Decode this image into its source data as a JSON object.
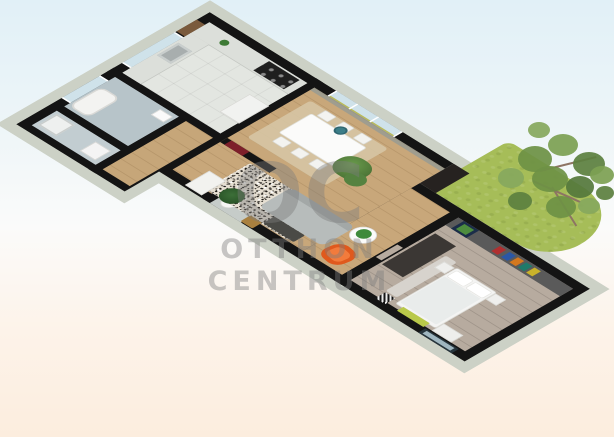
{
  "watermark": {
    "logo": "OC",
    "line1": "OTTHON",
    "line2": "CENTRUM"
  },
  "scene": {
    "kind": "3d-floor-plan-render-isometric",
    "rooms": [
      {
        "name": "kitchen"
      },
      {
        "name": "dining-room"
      },
      {
        "name": "living-room"
      },
      {
        "name": "bedroom"
      },
      {
        "name": "bathroom"
      },
      {
        "name": "shower-room"
      },
      {
        "name": "wc"
      },
      {
        "name": "hall"
      },
      {
        "name": "entry"
      },
      {
        "name": "garden"
      }
    ],
    "furniture": [
      "kitchen-counter",
      "stove",
      "sink",
      "fridge",
      "wall-cabinet",
      "dining-table",
      "dining-chairs",
      "pendant-lamp",
      "potted-plant",
      "dining-rug",
      "sofa",
      "coffee-table",
      "speckled-rug",
      "orange-armchair",
      "round-side-table",
      "floor-plant",
      "wooden-chair",
      "white-chest",
      "toilet",
      "bathtub",
      "wash-basin",
      "shower",
      "washing-machine",
      "bed",
      "pillows",
      "duvet",
      "dresser",
      "nightstands",
      "runner-rug",
      "bench",
      "striped-pouf",
      "wall-art",
      "bedroom-doors",
      "front-door",
      "interior-red-doors",
      "windows",
      "lawn",
      "tree"
    ]
  },
  "colors": {
    "bg_top": "#e1f0f7",
    "bg_mid": "#fbfbfa",
    "bg_bottom": "#fcedde",
    "wall": "#141414",
    "slab": "#ccd1c6",
    "wood": "#c8a77a",
    "bedroom_floor": "#b7ab9f",
    "kitchen_floor": "#e3e6e1",
    "lawn": "#a6bd58",
    "accent_wall": "#5a5a5a",
    "sofa": "#b7bcbb",
    "armchair": "#e0591d",
    "door_red": "#7d1f2a",
    "window_glass": "#cfe2ea",
    "watermark_color": "rgba(125,125,125,0.42)",
    "tree_green": "#6f9147"
  }
}
